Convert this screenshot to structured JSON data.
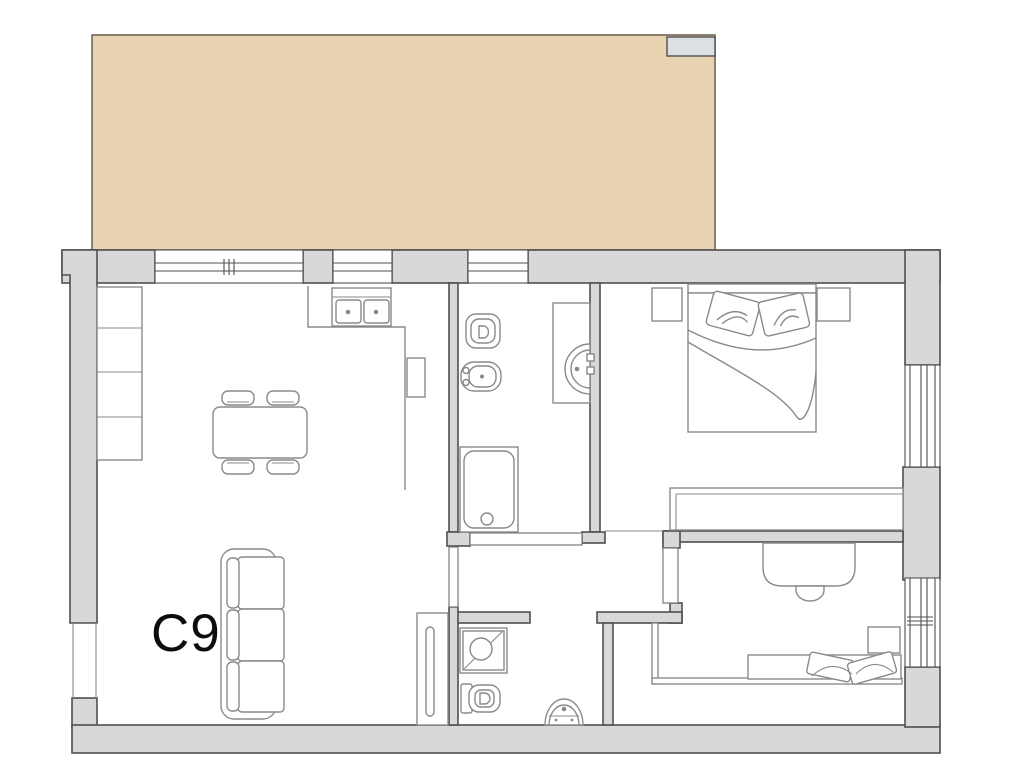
{
  "unit": {
    "label": "C9"
  },
  "colors": {
    "background": "#ffffff",
    "terrace_fill": "#e8d4b2",
    "terrace_border": "#6f6757",
    "notch_fill": "#dde0e3",
    "wall_fill": "#d8d8d8",
    "wall_stroke": "#4f4f4f",
    "line": "#8a8a8a",
    "door_line": "#7a7a7a",
    "label_color": "#0d0d0d"
  }
}
